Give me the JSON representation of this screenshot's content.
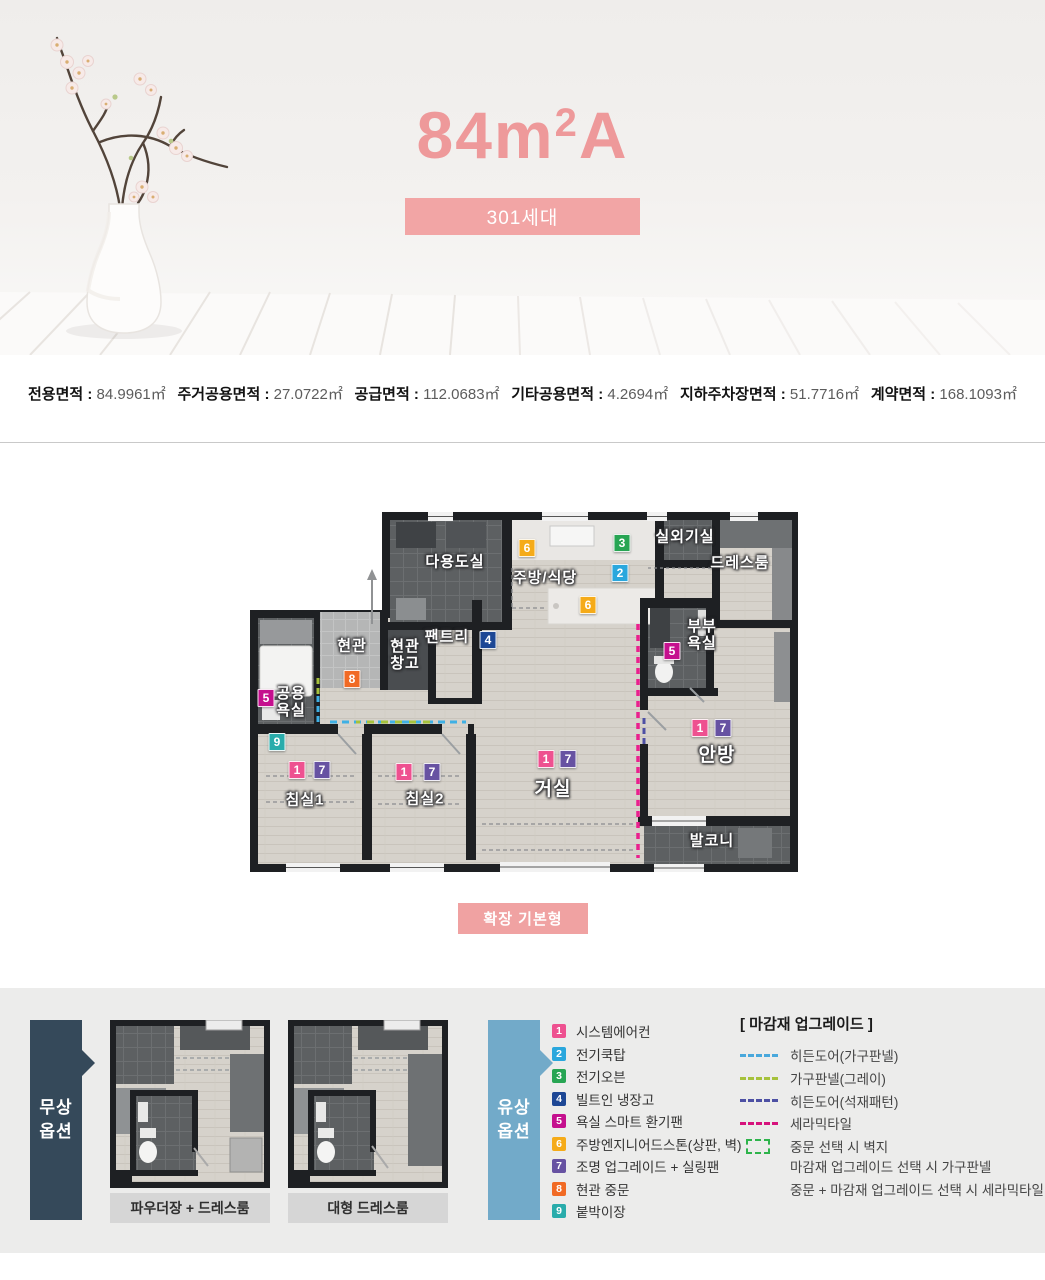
{
  "header": {
    "title_main": "84m",
    "title_sup": "2",
    "title_suffix": "A",
    "title_color": "#ee999a",
    "badge_label": "301세대",
    "badge_bg": "#f2a5a5"
  },
  "stats": {
    "separator": " : ",
    "items": [
      {
        "label": "전용면적",
        "value": "84.9961㎡"
      },
      {
        "label": "주거공용면적",
        "value": "27.0722㎡"
      },
      {
        "label": "공급면적",
        "value": "112.0683㎡"
      },
      {
        "label": "기타공용면적",
        "value": "4.2694㎡"
      },
      {
        "label": "지하주차장면적",
        "value": "51.7716㎡"
      },
      {
        "label": "계약면적",
        "value": "168.1093㎡"
      }
    ]
  },
  "floor_plan": {
    "type_button": "확장 기본형",
    "rooms": {
      "utility": "다용도실",
      "kitchen": "주방/식당",
      "outdoor_unit": "실외기실",
      "dress_room": "드레스룸",
      "entrance": "현관",
      "entrance_storage": "현관\n창고",
      "pantry": "팬트리",
      "master_bath": "부부\n욕실",
      "common_bath": "공용\n욕실",
      "bedroom1": "침실1",
      "bedroom2": "침실2",
      "living": "거실",
      "master_bedroom": "안방",
      "balcony": "발코니"
    }
  },
  "options": {
    "free_tab": "무상\n옵션",
    "paid_tab": "유상\n옵션",
    "free_tab_bg": "#35495a",
    "paid_tab_bg": "#72aac9",
    "mini_plans": [
      {
        "caption": "파우더장 + 드레스룸"
      },
      {
        "caption": "대형 드레스룸"
      }
    ],
    "legend": [
      {
        "num": "1",
        "color": "#ee5190",
        "label": "시스템에어컨"
      },
      {
        "num": "2",
        "color": "#2aa7dd",
        "label": "전기쿡탑"
      },
      {
        "num": "3",
        "color": "#27a553",
        "label": "전기오븐"
      },
      {
        "num": "4",
        "color": "#1d4795",
        "label": "빌트인 냉장고"
      },
      {
        "num": "5",
        "color": "#c5108e",
        "label": "욕실 스마트 환기팬"
      },
      {
        "num": "6",
        "color": "#f5ab19",
        "label": "주방엔지니어드스톤(상판, 벽)"
      },
      {
        "num": "7",
        "color": "#6752a2",
        "label": "조명 업그레이드 + 실링팬"
      },
      {
        "num": "8",
        "color": "#f16a24",
        "label": "현관 중문"
      },
      {
        "num": "9",
        "color": "#29acab",
        "label": "붙박이장"
      }
    ],
    "finish_upgrade": {
      "title": "[ 마감재 업그레이드 ]",
      "rows": [
        {
          "icon": "dash",
          "color": "#49a8dc",
          "label": "히든도어(가구판넬)"
        },
        {
          "icon": "dash",
          "color": "#a6c23c",
          "label": "가구판넬(그레이)"
        },
        {
          "icon": "dash",
          "color": "#4d50a4",
          "label": "히든도어(석재패턴)"
        },
        {
          "icon": "dash",
          "color": "#d6127c",
          "label": "세라믹타일"
        },
        {
          "icon": "rect",
          "color": "#2eb44b",
          "label": "중문 선택 시 벽지"
        }
      ],
      "notes": [
        "마감재 업그레이드 선택 시 가구판넬",
        "중문 + 마감재 업그레이드 선택 시 세라믹타일"
      ]
    }
  }
}
